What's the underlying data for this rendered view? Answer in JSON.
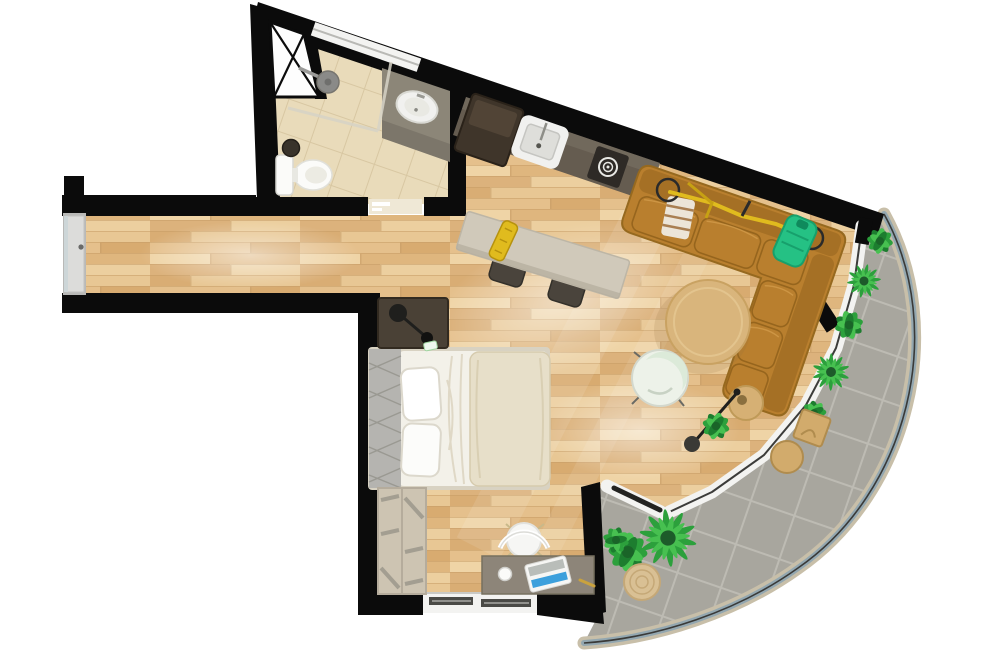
{
  "meta": {
    "title": "studio-apartment-floor-plan-top-down-render",
    "canvas": {
      "width": 1000,
      "height": 650
    }
  },
  "colors": {
    "background": "#ffffff",
    "wall": "#0b0b0b",
    "floor_wood": "#e6c28b",
    "floor_wood_light": "#f0d6a8",
    "floor_wood_dark": "#d3a368",
    "wood_seam": "#c79c66",
    "tile_beige": "#e9dbba",
    "tile_grout": "#d8c7a2",
    "balcony_floor": "#a8a69e",
    "balcony_grout": "#bdbbb3",
    "balcony_curb": "#c8bfa9",
    "railing_glass": "#93a7b0",
    "window_white": "#f3f3f1",
    "window_line": "#3c3c3a",
    "door_gray": "#dcdcda",
    "threshold": "#efe8d6",
    "shaft_white": "#fdfdfd",
    "counter_kitchen": "#655c50",
    "counter_bath": "#8c8678",
    "fridge": "#3f352a",
    "appliance_dark": "#2e2a26",
    "sink_white": "#f1f1ef",
    "toilet_white": "#fbfbf9",
    "shower_metal": "#8a8a88",
    "sofa": "#b97f2e",
    "sofa_dark": "#8e5f1a",
    "sofa_light": "#d29b4a",
    "bike_yellow": "#e0bb1e",
    "bag_green": "#25c184",
    "coffee_table": "#d9b57c",
    "side_table": "#d6b074",
    "stool_wood": "#d2ab6c",
    "stool_dark": "#4a443c",
    "high_table": "#d0c9ba",
    "egg_chair": "#edf2e9",
    "egg_chair_mint": "#dcead9",
    "bed_sheet": "#f3f1e9",
    "duvet": "#e7dfc9",
    "pillow": "#ffffff",
    "headboard": "#b5b4b0",
    "nightstand": "#4a4136",
    "wardrobe": "#cdc4b2",
    "wardrobe_strip": "#9f9a8e",
    "desk": "#8d8579",
    "chair_white": "#f6f6f4",
    "laptop_blue": "#3da0dc",
    "lamp_black": "#1f1f1d",
    "plant_green": "#2ca03c",
    "plant_green_light": "#47c050",
    "plant_green_dark": "#1d7d2f",
    "basket": "#d9c094"
  },
  "rooms": {
    "list": [
      "entry-hallway",
      "bathroom",
      "kitchenette",
      "living-area",
      "sleeping-area",
      "work-corner",
      "curved-balcony"
    ]
  },
  "inventory": {
    "bathroom": [
      "toilet",
      "washbasin-counter",
      "shower-head",
      "glass-partition",
      "waste-bin",
      "window"
    ],
    "kitchenette": [
      "counter",
      "refrigerator",
      "sink",
      "cooktop"
    ],
    "living_area": [
      "corner-sofa",
      "bicycle-on-sofa",
      "green-bag",
      "striped-towel",
      "coffee-table",
      "lounge-chair",
      "side-table",
      "floor-lamp",
      "potted-plant",
      "high-table",
      "stool",
      "stool"
    ],
    "sleeping_area": [
      "double-bed",
      "tufted-headboard",
      "pillows",
      "duvet",
      "nightstand",
      "reading-lamp",
      "wardrobe"
    ],
    "work_corner": [
      "desk",
      "chair",
      "laptop",
      "mug",
      "window"
    ],
    "balcony": [
      "planter",
      "planter",
      "planter",
      "planter",
      "planter",
      "square-stool",
      "round-stool",
      "palm-plant",
      "shrub-plant",
      "woven-basket",
      "sliding-door"
    ],
    "structure": [
      "entrance-door",
      "bathroom-door-opening",
      "shaft-x-brace",
      "curved-glass-railing"
    ]
  }
}
